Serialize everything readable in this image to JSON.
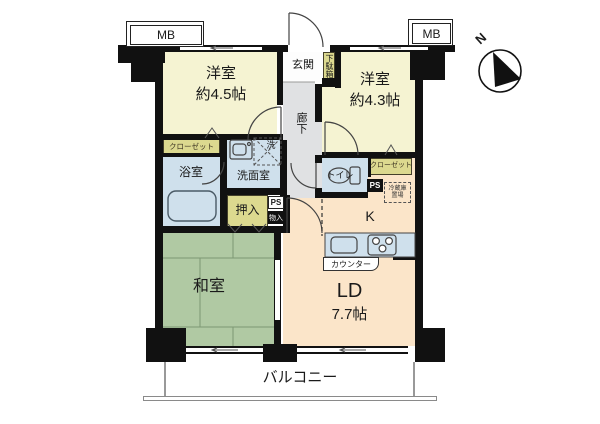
{
  "colors": {
    "wall": "#111111",
    "western_room_fill": "#f5f3d2",
    "tatami_fill": "#b0c9a3",
    "living_dining_fill": "#fbe5c9",
    "wet_area_fill": "#cfe0ec",
    "closet_fill": "#dcd98f",
    "corridor_fill": "#e0e1e3"
  },
  "compass": {
    "north_label": "N"
  },
  "meter_boxes": {
    "left": "MB",
    "right": "MB"
  },
  "entrance": {
    "genkan": "玄関",
    "shoe_cabinet": "下駄箱",
    "corridor": "廊下"
  },
  "rooms": {
    "western1": {
      "name": "洋室",
      "size": "約4.5帖"
    },
    "western2": {
      "name": "洋室",
      "size": "約4.3帖"
    },
    "japanese_room": {
      "name": "和室"
    },
    "living_dining": {
      "name": "LD",
      "size": "7.7帖"
    },
    "kitchen": {
      "name": "K"
    },
    "bathroom": {
      "name": "浴室"
    },
    "washroom": {
      "name": "洗面室"
    },
    "toilet": {
      "name": "トイレ"
    }
  },
  "storage": {
    "closet_left": "クローゼット",
    "closet_right": "クローゼット",
    "oshiire": "押入",
    "monoire": "物入",
    "fridge_line1": "冷蔵庫",
    "fridge_line2": "置場"
  },
  "fixtures": {
    "counter": "カウンター",
    "laundry": "洗"
  },
  "shafts": {
    "ps_left": "PS",
    "ps_right": "PS"
  },
  "outdoor": {
    "balcony": "バルコニー"
  }
}
